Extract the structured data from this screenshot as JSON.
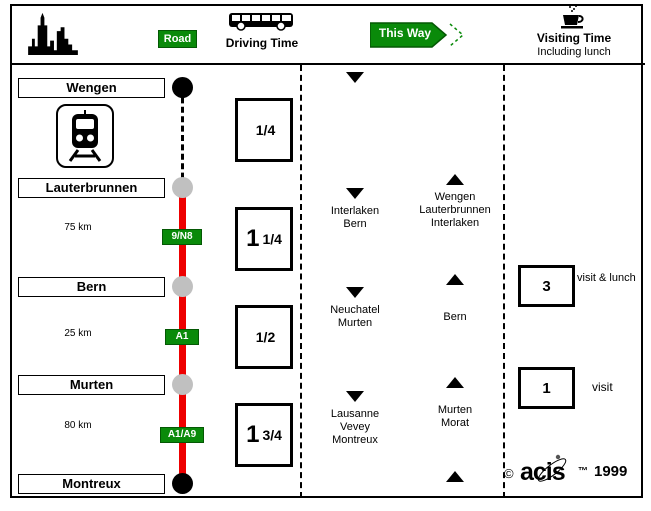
{
  "header": {
    "road_label": "Road",
    "driving_time_label": "Driving Time",
    "this_way_label": "This Way",
    "visiting_time_label": "Visiting Time",
    "visiting_time_subtitle": "Including lunch"
  },
  "route": {
    "stations": [
      {
        "name": "Wengen",
        "marker": "terminus"
      },
      {
        "name": "Lauterbrunnen",
        "marker": "stop"
      },
      {
        "name": "Bern",
        "marker": "stop"
      },
      {
        "name": "Murten",
        "marker": "stop"
      },
      {
        "name": "Montreux",
        "marker": "terminus"
      }
    ],
    "segments": [
      {
        "from": "Wengen",
        "to": "Lauterbrunnen",
        "mode": "rail",
        "distance": "",
        "road": ""
      },
      {
        "from": "Lauterbrunnen",
        "to": "Bern",
        "mode": "road",
        "distance": "75 km",
        "road": "9/N8"
      },
      {
        "from": "Bern",
        "to": "Murten",
        "mode": "road",
        "distance": "25 km",
        "road": "A1"
      },
      {
        "from": "Murten",
        "to": "Montreux",
        "mode": "road",
        "distance": "80 km",
        "road": "A1/A9"
      }
    ]
  },
  "driving_times": [
    {
      "whole": "",
      "fraction": "1/4"
    },
    {
      "whole": "1",
      "fraction": "1/4"
    },
    {
      "whole": "",
      "fraction": "1/2"
    },
    {
      "whole": "1",
      "fraction": "3/4"
    }
  ],
  "this_way": {
    "down_moves": [
      "",
      "Interlaken\nBern",
      "Neuchatel\nMurten",
      "Lausanne\nVevey\nMontreux"
    ],
    "up_moves": [
      "Wengen\nLauterbrunnen\nInterlaken",
      "Bern",
      "Murten\nMorat",
      ""
    ]
  },
  "visiting_times": [
    {
      "hours": "3",
      "label": "visit & lunch"
    },
    {
      "hours": "1",
      "label": "visit"
    }
  ],
  "footer": {
    "copyright": "©",
    "brand": "acis",
    "trademark": "™",
    "year": "1999"
  },
  "colors": {
    "green": "#0a8a0a",
    "green_dark": "#045804",
    "red": "#ee0000",
    "gray_stop": "#c0c0c0",
    "black": "#000000"
  }
}
